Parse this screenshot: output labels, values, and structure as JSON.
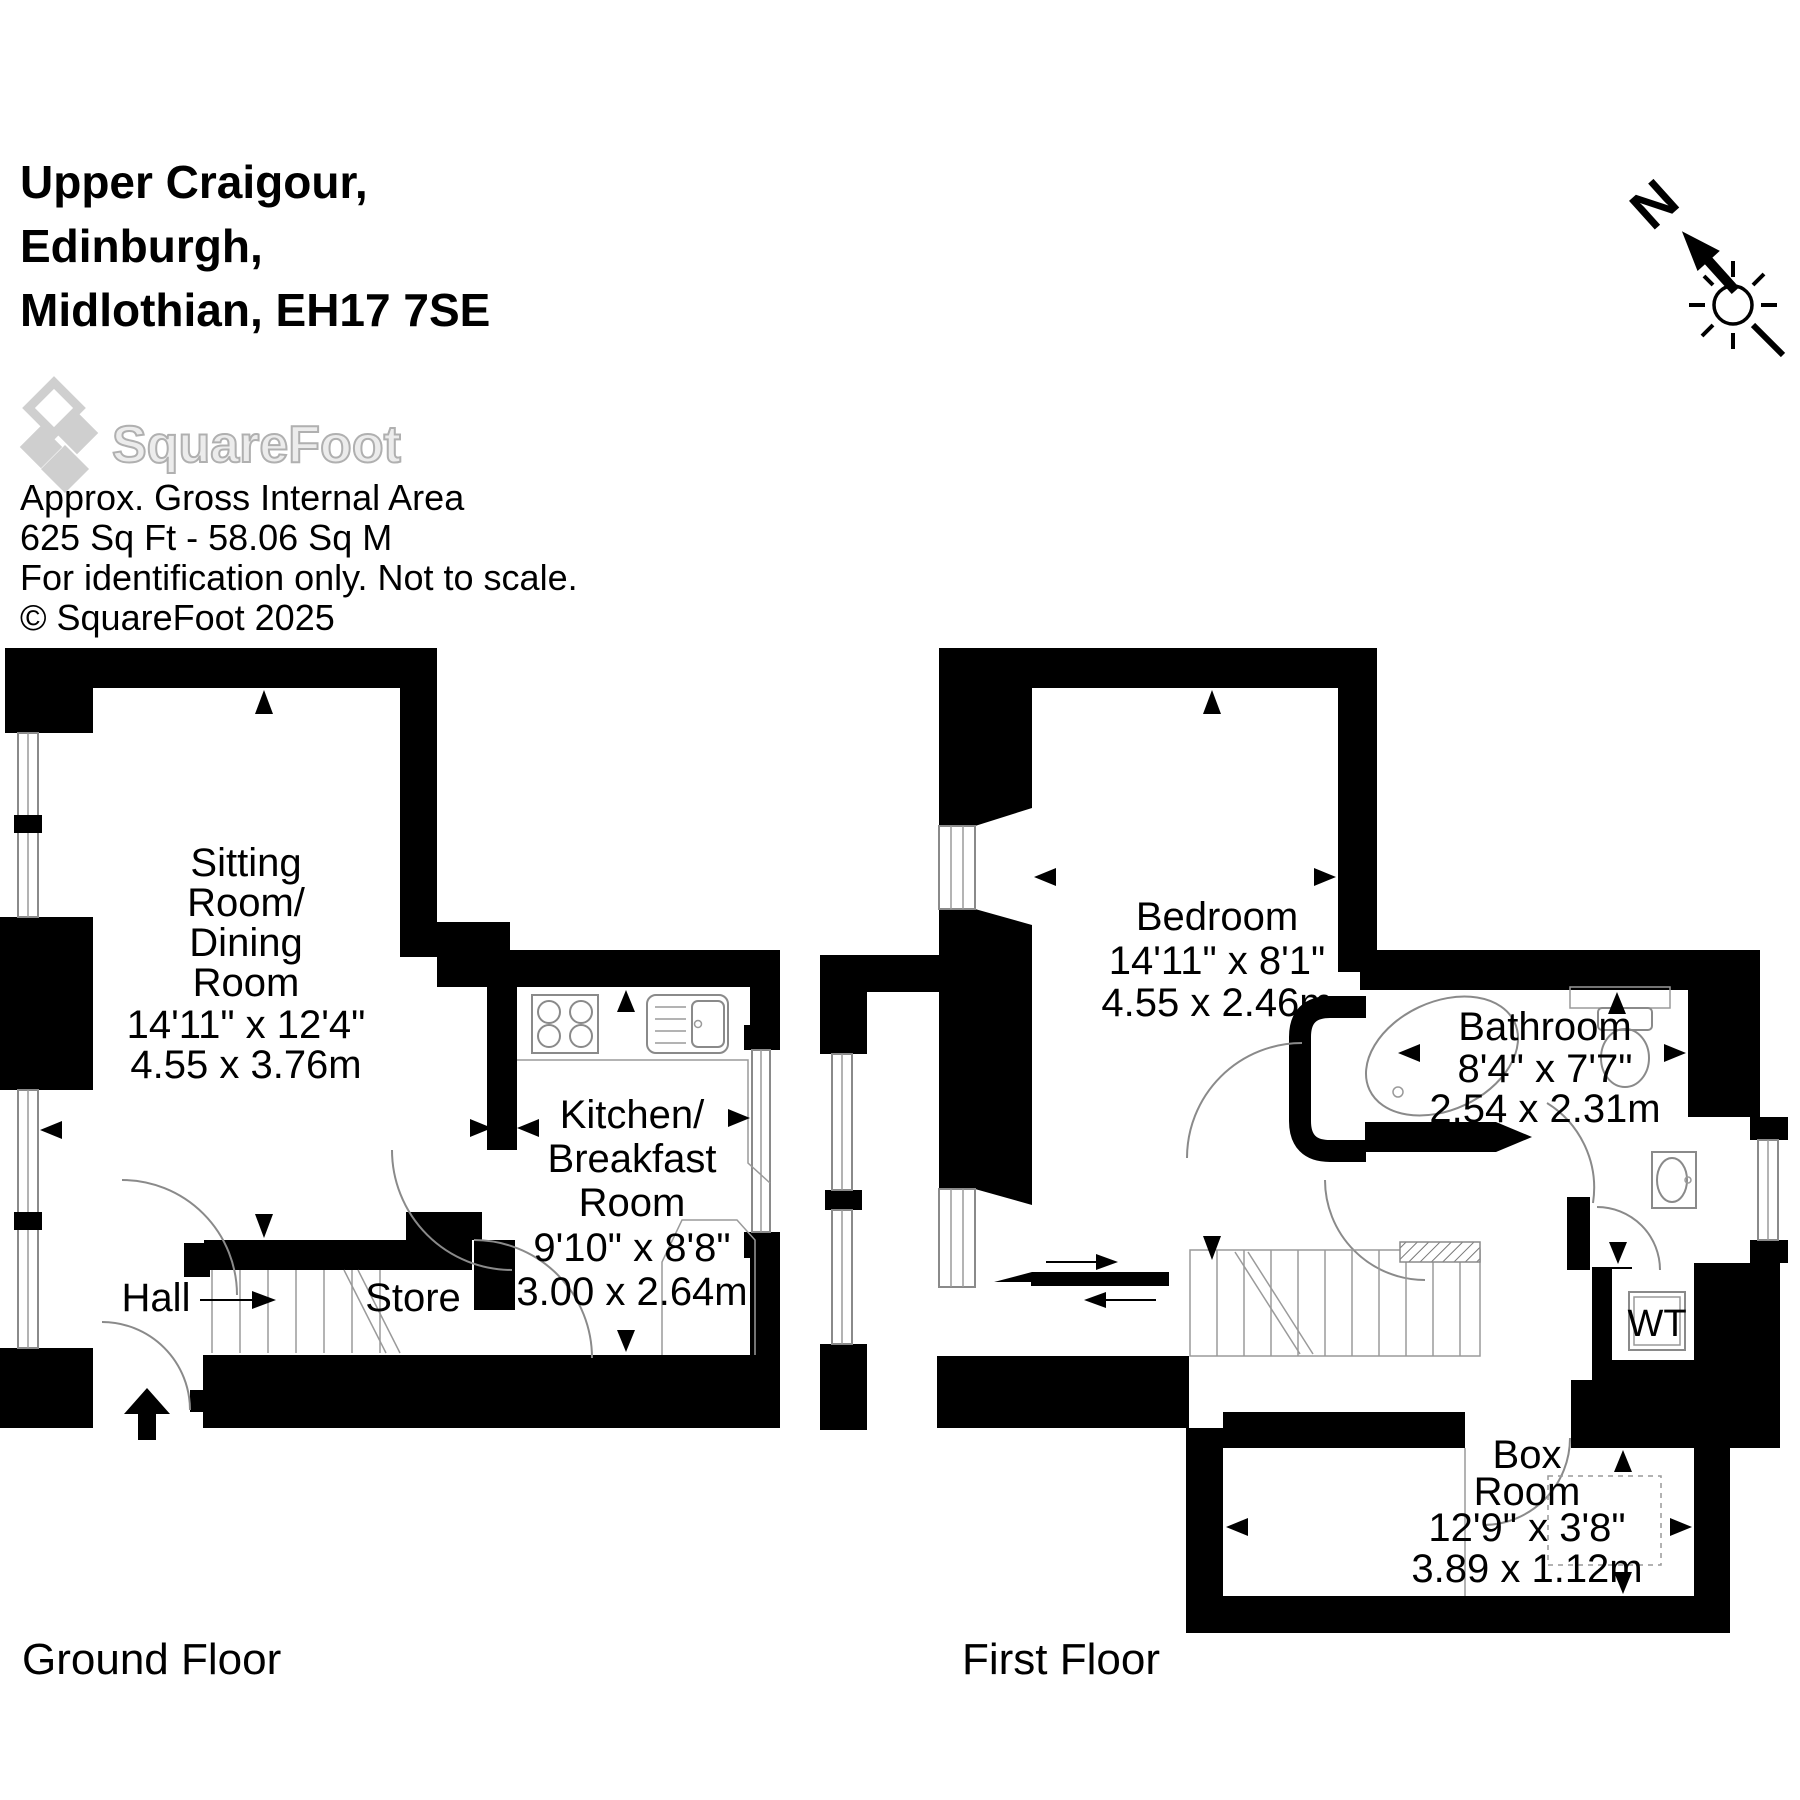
{
  "header": {
    "address_lines": [
      "Upper Craigour,",
      "Edinburgh,",
      "Midlothian, EH17 7SE"
    ],
    "logo_text": "SquareFoot",
    "area_title": "Approx. Gross Internal Area",
    "area_value": "625 Sq Ft  -  58.06 Sq M",
    "disclaimer": "For identification only. Not to scale.",
    "copyright": "© SquareFoot 2025"
  },
  "compass": {
    "north_label": "N"
  },
  "ground_floor": {
    "label": "Ground Floor",
    "sitting_room": {
      "lines": [
        "Sitting",
        "Room/",
        "Dining",
        "Room",
        "14'11\" x 12'4\"",
        "4.55 x 3.76m"
      ]
    },
    "kitchen": {
      "lines": [
        "Kitchen/",
        "Breakfast",
        "Room",
        "9'10\" x 8'8\"",
        "3.00 x 2.64m"
      ]
    },
    "hall_label": "Hall",
    "store_label": "Store"
  },
  "first_floor": {
    "label": "First Floor",
    "bedroom": {
      "lines": [
        "Bedroom",
        "14'11\" x 8'1\"",
        "4.55 x 2.46m"
      ]
    },
    "bathroom": {
      "lines": [
        "Bathroom",
        "8'4\" x 7'7\"",
        "2.54 x 2.31m"
      ]
    },
    "wt_label": "WT",
    "box_room": {
      "lines": [
        "Box",
        "Room",
        "12'9\" x 3'8\"",
        "3.89 x 1.12m"
      ]
    }
  },
  "colors": {
    "wall": "#000000",
    "line": "#8a8a8a",
    "logo_gray": "#cfcfcf"
  }
}
